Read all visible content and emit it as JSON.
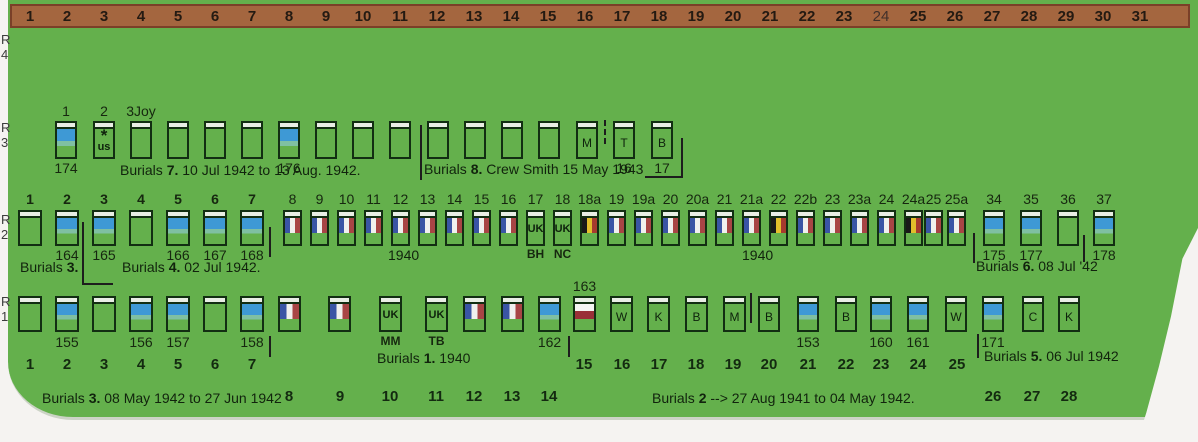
{
  "colors": {
    "field_green": "#64b04c",
    "ruler_brown": "#a4663f",
    "ruler_border": "#7a4028",
    "grave_outline": "#122e12",
    "headstone_blue": "#3e99d5",
    "france_blue": "#3a55a5",
    "france_red": "#a84545",
    "belgium_black": "#191919",
    "belgium_yellow": "#e2bf2b",
    "belgium_red": "#a63a2e",
    "poland_red": "#9a3038",
    "text_dark": "#11230d"
  },
  "top_ruler": {
    "numbers": [
      "1",
      "2",
      "3",
      "4",
      "5",
      "6",
      "7",
      "8",
      "9",
      "10",
      "11",
      "12",
      "13",
      "14",
      "15",
      "16",
      "17",
      "18",
      "19",
      "20",
      "21",
      "22",
      "23",
      "24",
      "25",
      "26",
      "27",
      "28",
      "29",
      "30",
      "31"
    ],
    "thin": [
      "24"
    ]
  },
  "row_labels": [
    "R4",
    "R3",
    "R2",
    "R1"
  ],
  "rows": {
    "r3": {
      "graves": [
        {
          "above": "1",
          "type": "blue",
          "below": "174"
        },
        {
          "above": "2",
          "type": "us"
        },
        {
          "above": "3Joy",
          "type": "plain"
        },
        {
          "type": "plain"
        },
        {
          "type": "plain"
        },
        {
          "type": "plain"
        },
        {
          "type": "blue",
          "below": "176"
        },
        {
          "type": "plain"
        },
        {
          "type": "plain"
        },
        {
          "type": "plain"
        },
        {
          "type": "plain"
        },
        {
          "type": "plain"
        },
        {
          "type": "plain"
        },
        {
          "type": "plain"
        },
        {
          "type": "letter",
          "letter": "M"
        },
        {
          "type": "letter",
          "letter": "T",
          "below": "16"
        },
        {
          "type": "letter",
          "letter": "B",
          "below": "17"
        }
      ],
      "notes": {
        "burials7": "Burials 7. 10 Jul 1942 to 13 Aug. 1942.",
        "burials8": "Burials 8. Crew Smith 15 May 1943"
      }
    },
    "r2": {
      "graves": [
        {
          "above": "1",
          "above_bold": true,
          "type": "plain"
        },
        {
          "above": "2",
          "above_bold": true,
          "type": "blue",
          "below": "164"
        },
        {
          "above": "3",
          "above_bold": true,
          "type": "blue",
          "below": "165"
        },
        {
          "above": "4",
          "above_bold": true,
          "type": "plain"
        },
        {
          "above": "5",
          "above_bold": true,
          "type": "blue",
          "below": "166"
        },
        {
          "above": "6",
          "above_bold": true,
          "type": "blue",
          "below": "167"
        },
        {
          "above": "7",
          "above_bold": true,
          "type": "blue",
          "below": "168"
        },
        {
          "above": "8",
          "type": "france"
        },
        {
          "above": "9",
          "type": "france"
        },
        {
          "above": "10",
          "type": "france"
        },
        {
          "above": "11",
          "type": "france"
        },
        {
          "above": "12",
          "type": "france"
        },
        {
          "above": "13",
          "type": "france"
        },
        {
          "above": "14",
          "type": "france"
        },
        {
          "above": "15",
          "type": "france"
        },
        {
          "above": "16",
          "type": "france"
        },
        {
          "above": "17",
          "type": "uk",
          "below": "BH",
          "below_bold": true
        },
        {
          "above": "18",
          "type": "uk",
          "below": "NC",
          "below_bold": true
        },
        {
          "above": "18a",
          "type": "belgium"
        },
        {
          "above": "19",
          "type": "france"
        },
        {
          "above": "19a",
          "type": "france"
        },
        {
          "above": "20",
          "type": "france"
        },
        {
          "above": "20a",
          "type": "france"
        },
        {
          "above": "21",
          "type": "france"
        },
        {
          "above": "21a",
          "type": "france"
        },
        {
          "above": "22",
          "type": "belgium"
        },
        {
          "above": "22b",
          "type": "france"
        },
        {
          "above": "23",
          "type": "france"
        },
        {
          "above": "23a",
          "type": "france"
        },
        {
          "above": "24",
          "type": "france"
        },
        {
          "above": "24a",
          "type": "belgium"
        },
        {
          "above": "25",
          "type": "france"
        },
        {
          "above": "25a",
          "type": "france"
        },
        {
          "above": "34",
          "type": "blue",
          "below": "175"
        },
        {
          "above": "35",
          "type": "blue",
          "below": "177"
        },
        {
          "above": "36",
          "type": "plain"
        },
        {
          "above": "37",
          "type": "blue",
          "below": "178"
        }
      ],
      "notes": {
        "burials3": "Burials 3.",
        "burials4": "Burials 4. 02 Jul 1942.",
        "year_1940_left": "1940",
        "year_1940_right": "1940",
        "burials6": "Burials 6. 08 Jul '42"
      }
    },
    "r1": {
      "graves": [
        {
          "type": "plain"
        },
        {
          "type": "blue",
          "below": "155"
        },
        {
          "type": "plain"
        },
        {
          "type": "blue",
          "below": "156"
        },
        {
          "type": "blue",
          "below": "157"
        },
        {
          "type": "plain"
        },
        {
          "type": "blue",
          "below": "158"
        },
        {
          "type": "france"
        },
        {
          "type": "france"
        },
        {
          "type": "uk",
          "below": "MM",
          "below_bold": true
        },
        {
          "type": "uk",
          "below": "TB",
          "below_bold": true
        },
        {
          "type": "france"
        },
        {
          "type": "france"
        },
        {
          "type": "blue",
          "below": "162"
        },
        {
          "above": "163",
          "type": "poland"
        },
        {
          "type": "letter",
          "letter": "W"
        },
        {
          "type": "letter",
          "letter": "K"
        },
        {
          "type": "letter",
          "letter": "B"
        },
        {
          "type": "letter",
          "letter": "M"
        },
        {
          "type": "letter",
          "letter": "B"
        },
        {
          "type": "blue",
          "below": "153"
        },
        {
          "type": "letter",
          "letter": "B"
        },
        {
          "type": "blue",
          "below": "160"
        },
        {
          "type": "blue",
          "below": "161"
        },
        {
          "type": "letter",
          "letter": "W"
        },
        {
          "type": "blue",
          "below": "171"
        },
        {
          "type": "letter",
          "letter": "C"
        },
        {
          "type": "letter",
          "letter": "K"
        }
      ],
      "notes": {
        "burials1": "Burials 1. 1940",
        "burials5": "Burials 5. 06 Jul 1942"
      }
    }
  },
  "bottom": {
    "number_rows": [
      [
        "1",
        "2",
        "3",
        "4",
        "5",
        "6",
        "7"
      ],
      [
        "8",
        "9",
        "10",
        "11",
        "12",
        "13",
        "14"
      ],
      [
        "15",
        "16",
        "17",
        "18",
        "19",
        "20",
        "21",
        "22",
        "23",
        "24",
        "25"
      ],
      [
        "26",
        "27",
        "28"
      ]
    ],
    "notes": {
      "burials3_range": "Burials 3. 08 May 1942 to 27 Jun 1942",
      "burials2_range": "Burials 2 --> 27 Aug 1941 to 04 May 1942."
    }
  }
}
